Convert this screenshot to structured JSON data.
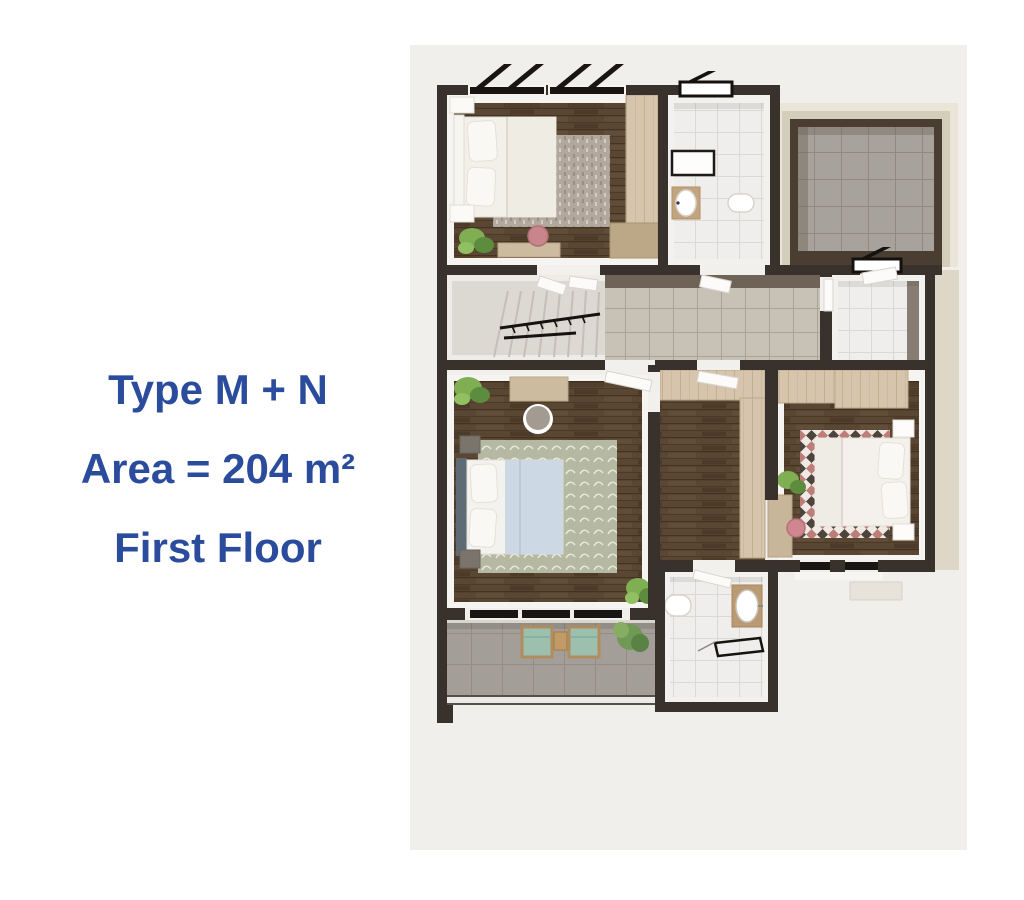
{
  "page": {
    "background": "#ffffff"
  },
  "caption": {
    "lines": [
      "Type M + N",
      "Area = 204 m²",
      "First Floor"
    ],
    "color": "#2b4c9c"
  },
  "floor_plan": {
    "canvas_color": "#f1efec",
    "wall_color": "#39322c",
    "rooms": [
      "bedroom-1",
      "bathroom-1",
      "terrace",
      "stair-hall",
      "hallway",
      "laundry-room",
      "master-bedroom",
      "dressing-corridor",
      "bedroom-2",
      "balcony",
      "ensuite-bathroom"
    ],
    "colors": {
      "wood_floor": "#5a4733",
      "light_wood_closet": "#d6c5ac",
      "white_tile": "#f0eeec",
      "beige_tile": "#c8c1b5",
      "terrace_tile": "#a8a29c",
      "rug_sage": "#b6b9a2",
      "rug_gray": "#b3a89d",
      "rug_red_accent": "#bd7d79",
      "plant_green": "#7fae53",
      "pouf_pink": "#ce8790",
      "bed_linen": "#f4f1ec",
      "blanket_blue": "#ccd8e3"
    }
  }
}
